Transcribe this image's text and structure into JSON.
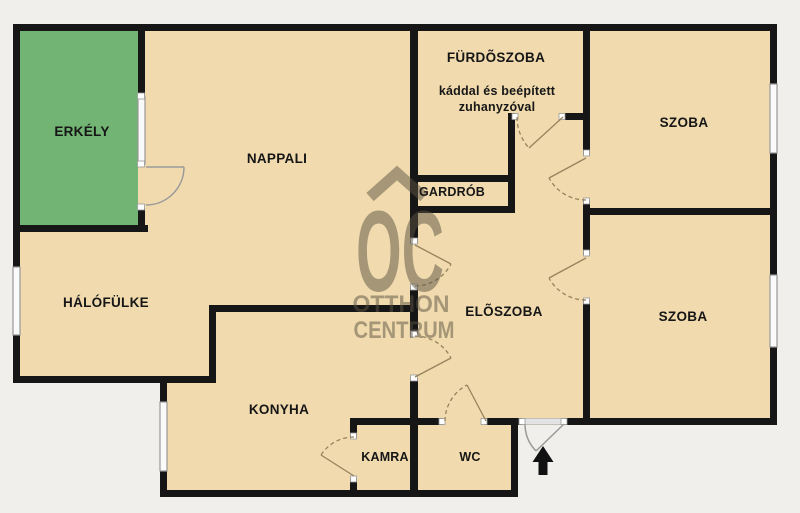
{
  "plan": {
    "type": "apartment-floor-plan",
    "entrance_marker": "up-arrow"
  },
  "rooms": {
    "erkely": {
      "label": "ERKÉLY"
    },
    "nappali": {
      "label": "NAPPALI"
    },
    "furdoszoba": {
      "label": "FÜRDÕSZOBA",
      "note_line1": "káddal és beépített",
      "note_line2": "zuhanyzóval"
    },
    "szoba_top": {
      "label": "SZOBA"
    },
    "gardrob": {
      "label": "GARDRÓB"
    },
    "halofulke": {
      "label": "HÁLÓFÜLKE"
    },
    "eloszoba": {
      "label": "ELÕSZOBA"
    },
    "szoba_bottom": {
      "label": "SZOBA"
    },
    "konyha": {
      "label": "KONYHA"
    },
    "kamra": {
      "label": "KAMRA"
    },
    "wc": {
      "label": "WC"
    }
  },
  "watermark": {
    "logo_text": "OC",
    "line1": "OTTHON",
    "line2": "CENTRUM"
  },
  "colors": {
    "page_background": "#f1efeb",
    "room_fill": "#f0daae",
    "balcony_green": "#72b473",
    "wall": "#161616",
    "watermark": "#5c5442",
    "window": "#fafafa",
    "door_line": "#97835c"
  }
}
